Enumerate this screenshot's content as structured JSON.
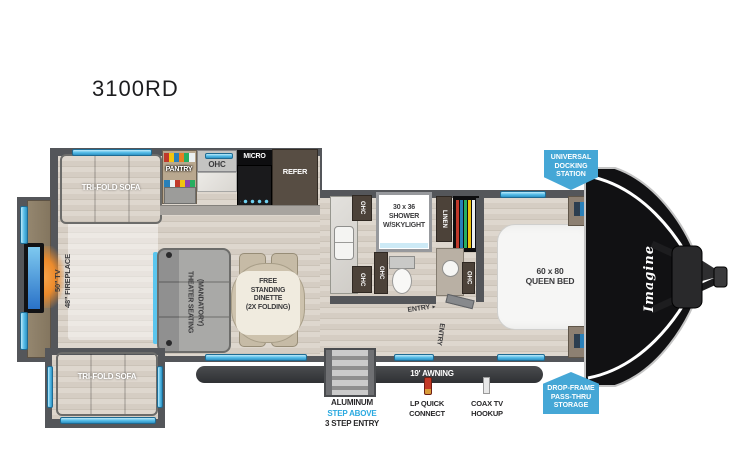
{
  "title": "3100RD",
  "colors": {
    "badge": "#45a7d6",
    "window": "#5bc6ee",
    "step_above": "#2aa9e0"
  },
  "living": {
    "sofa_top": "TRI-FOLD SOFA",
    "sofa_slide": "TRI-FOLD SOFA",
    "tv": "50\" TV",
    "fireplace": "48\" FIREPLACE",
    "theater": [
      "THEATER SEATING",
      "(MANDATORY)"
    ],
    "dinette": [
      "FREE",
      "STANDING",
      "DINETTE",
      "(2X FOLDING)"
    ]
  },
  "kitchen": {
    "pantry": "PANTRY",
    "ohc": "OHC",
    "micro": "MICRO",
    "refer": "REFER",
    "sink_ohc": [
      "OHC",
      "OHC"
    ]
  },
  "bath": {
    "shower": [
      "30 x 36",
      "SHOWER",
      "W/SKYLIGHT"
    ],
    "ohc_toilet": "OHC",
    "linen": "LINEN",
    "ohc_vanity": "OHC",
    "entry": "ENTRY",
    "entry_arrow": "►",
    "entry_bedroom": "ENTRY"
  },
  "bedroom": {
    "bed": [
      "60 x 80",
      "QUEEN BED"
    ],
    "overhead_cabinets": "OVERHEAD CABINETS",
    "brand": "Imagine"
  },
  "badges": {
    "docking": [
      "UNIVERSAL",
      "DOCKING",
      "STATION"
    ],
    "storage": [
      "DROP-FRAME",
      "PASS-THRU",
      "STORAGE"
    ]
  },
  "exterior": {
    "awning": "19' AWNING",
    "steps": [
      "ALUMINUM",
      "STEP ABOVE",
      "3 STEP ENTRY"
    ],
    "lp": [
      "LP QUICK",
      "CONNECT"
    ],
    "coax": [
      "COAX TV",
      "HOOKUP"
    ]
  }
}
